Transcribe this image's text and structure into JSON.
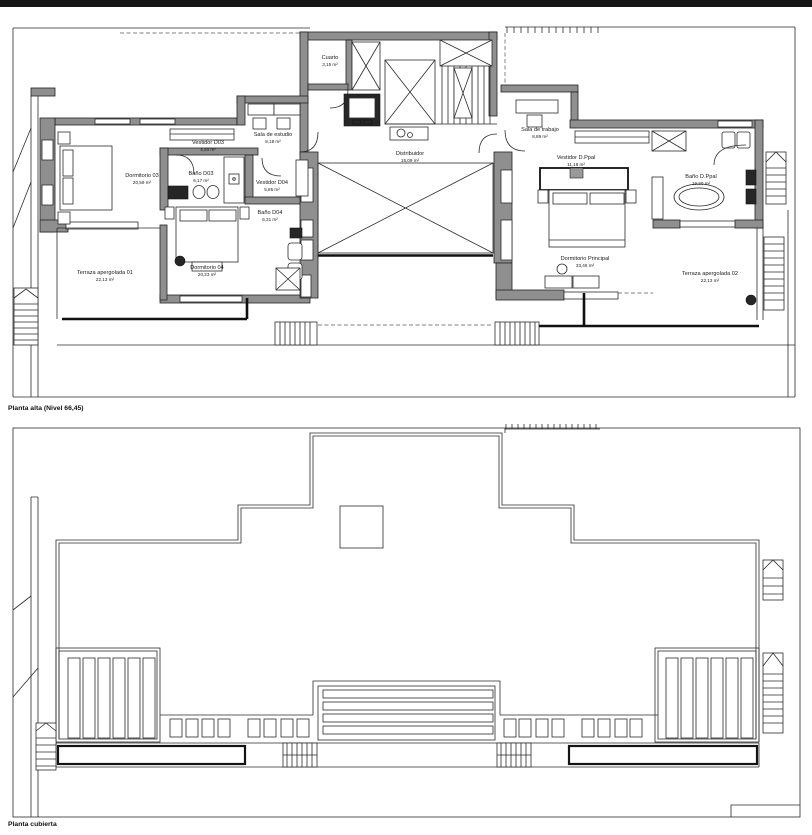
{
  "document": {
    "type": "architectural floor plans",
    "topbar_color": "#161616",
    "wall_color": "#8f8f8f",
    "ink_color": "#1a1a1a"
  },
  "plans": [
    {
      "title": "Planta alta (Nivel 66,45)",
      "rooms": [
        {
          "name": "Cuarto",
          "area": "3,15 m²"
        },
        {
          "name": "Distribuidor",
          "area": "15,09 m²"
        },
        {
          "name": "Sala de estudio",
          "area": "8,18 m²"
        },
        {
          "name": "Vestidor D03",
          "area": "4,20 m²"
        },
        {
          "name": "Dormitorio 03",
          "area": "20,59 m²"
        },
        {
          "name": "Baño D03",
          "area": "6,17 m²"
        },
        {
          "name": "Vestidor D04",
          "area": "5,85 m²"
        },
        {
          "name": "Baño D04",
          "area": "6,31 m²"
        },
        {
          "name": "Dormitorio 04",
          "area": "20,23 m²"
        },
        {
          "name": "Terraza apergolada 01",
          "area": "22,13 m²"
        },
        {
          "name": "Sala de trabajo",
          "area": "8,89 m²"
        },
        {
          "name": "Vestidor D.Ppal",
          "area": "11,18 m²"
        },
        {
          "name": "Baño D.Ppal",
          "area": "19,20 m²"
        },
        {
          "name": "Dormitorio Principal",
          "area": "33,46 m²"
        },
        {
          "name": "Terraza apergolada 02",
          "area": "22,13 m²"
        }
      ]
    },
    {
      "title": "Planta cubierta",
      "rooms": []
    }
  ]
}
